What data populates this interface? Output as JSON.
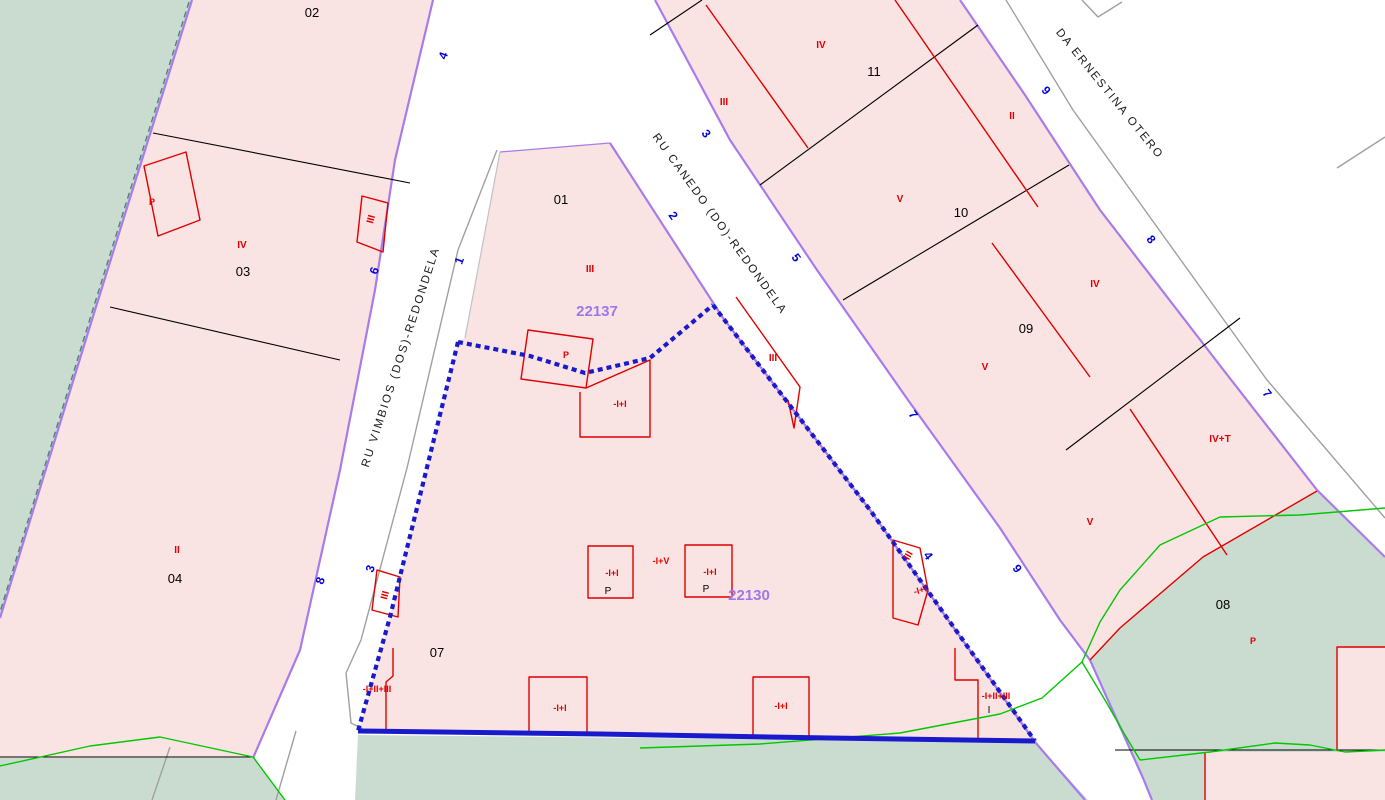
{
  "map": {
    "colors": {
      "parcel_pink": "#fae3e3",
      "green_area": "#cadccf",
      "road_purple": "#a87beb",
      "selection_blue": "#1a1acd",
      "building_red": "#e00000",
      "vegetation_green": "#00c800",
      "number_blue": "#0000dd",
      "ref_purple": "#9b79e8",
      "dashed_teal": "#4a8578",
      "line_black": "#000000",
      "line_gray": "#a0a0a0"
    },
    "streets": [
      {
        "text": "RU VIMBIOS (DOS)-REDONDELA",
        "x": 404,
        "y": 358,
        "rot": -72,
        "name": "street-name-ru-vimbios"
      },
      {
        "text": "RU CANEDO (DO)-REDONDELA",
        "x": 717,
        "y": 226,
        "rot": 54,
        "name": "street-name-ru-canedo"
      },
      {
        "text": "DA ERNESTINA OTERO",
        "x": 1107,
        "y": 96,
        "rot": 51,
        "name": "street-name-da-ernestina-otero"
      }
    ],
    "parcel_numbers": [
      {
        "text": "02",
        "x": 312,
        "y": 17
      },
      {
        "text": "03",
        "x": 243,
        "y": 276
      },
      {
        "text": "04",
        "x": 175,
        "y": 583
      },
      {
        "text": "01",
        "x": 561,
        "y": 204
      },
      {
        "text": "07",
        "x": 437,
        "y": 657
      },
      {
        "text": "11",
        "x": 874,
        "y": 76
      },
      {
        "text": "10",
        "x": 961,
        "y": 217
      },
      {
        "text": "09",
        "x": 1026,
        "y": 333
      },
      {
        "text": "08",
        "x": 1223,
        "y": 609
      }
    ],
    "construction_labels": [
      {
        "text": "IV",
        "x": 242,
        "y": 248
      },
      {
        "text": "II",
        "x": 177,
        "y": 553
      },
      {
        "text": "III",
        "x": 590,
        "y": 272
      },
      {
        "text": "III",
        "x": 374,
        "y": 220,
        "rot": -75
      },
      {
        "text": "IV",
        "x": 821,
        "y": 48
      },
      {
        "text": "III",
        "x": 724,
        "y": 105
      },
      {
        "text": "V",
        "x": 900,
        "y": 202
      },
      {
        "text": "II",
        "x": 1012,
        "y": 119
      },
      {
        "text": "IV",
        "x": 1095,
        "y": 287
      },
      {
        "text": "V",
        "x": 985,
        "y": 370
      },
      {
        "text": "IV+T",
        "x": 1220,
        "y": 442
      },
      {
        "text": "V",
        "x": 1090,
        "y": 525
      },
      {
        "text": "III",
        "x": 388,
        "y": 596,
        "rot": -75
      },
      {
        "text": "III",
        "x": 773,
        "y": 361
      },
      {
        "text": "III",
        "x": 911,
        "y": 557,
        "rot": -60
      }
    ],
    "building_labels": [
      {
        "text": "P",
        "x": 152,
        "y": 205
      },
      {
        "text": "P",
        "x": 566,
        "y": 358
      },
      {
        "text": "P",
        "x": 1253,
        "y": 644
      },
      {
        "text": "-I+I",
        "x": 620,
        "y": 407
      },
      {
        "text": "-I+I",
        "x": 612,
        "y": 576
      },
      {
        "text": "-I+V",
        "x": 661,
        "y": 564
      },
      {
        "text": "-I+I",
        "x": 710,
        "y": 575
      },
      {
        "text": "P",
        "x": 608,
        "y": 594,
        "cls": "black-p"
      },
      {
        "text": "P",
        "x": 706,
        "y": 592,
        "cls": "black-p"
      },
      {
        "text": "-I+I",
        "x": 560,
        "y": 711
      },
      {
        "text": "-I+I",
        "x": 781,
        "y": 709
      },
      {
        "text": "-I+II+III",
        "x": 377,
        "y": 692
      },
      {
        "text": "-I+II+III",
        "x": 996,
        "y": 699
      },
      {
        "text": "I",
        "x": 989,
        "y": 713,
        "cls": "black-i"
      },
      {
        "text": "-I+I",
        "x": 921,
        "y": 593,
        "rot": -15
      }
    ],
    "reference_numbers": [
      {
        "text": "22137",
        "x": 597,
        "y": 316
      },
      {
        "text": "22130",
        "x": 749,
        "y": 600
      }
    ],
    "street_numbers": [
      {
        "text": "4",
        "x": 447,
        "y": 57,
        "rot": -70
      },
      {
        "text": "1",
        "x": 463,
        "y": 262,
        "rot": -70
      },
      {
        "text": "6",
        "x": 378,
        "y": 272,
        "rot": -70
      },
      {
        "text": "3",
        "x": 374,
        "y": 570,
        "rot": -70
      },
      {
        "text": "8",
        "x": 324,
        "y": 582,
        "rot": -70
      },
      {
        "text": "3",
        "x": 703,
        "y": 136,
        "rot": 54
      },
      {
        "text": "2",
        "x": 670,
        "y": 218,
        "rot": 54
      },
      {
        "text": "5",
        "x": 793,
        "y": 260,
        "rot": 54
      },
      {
        "text": "7",
        "x": 910,
        "y": 417,
        "rot": 54
      },
      {
        "text": "4",
        "x": 925,
        "y": 558,
        "rot": 54
      },
      {
        "text": "9",
        "x": 1014,
        "y": 571,
        "rot": 54
      },
      {
        "text": "9",
        "x": 1043,
        "y": 93,
        "rot": 51
      },
      {
        "text": "8",
        "x": 1148,
        "y": 242,
        "rot": 51
      },
      {
        "text": "7",
        "x": 1264,
        "y": 396,
        "rot": 51
      }
    ]
  }
}
